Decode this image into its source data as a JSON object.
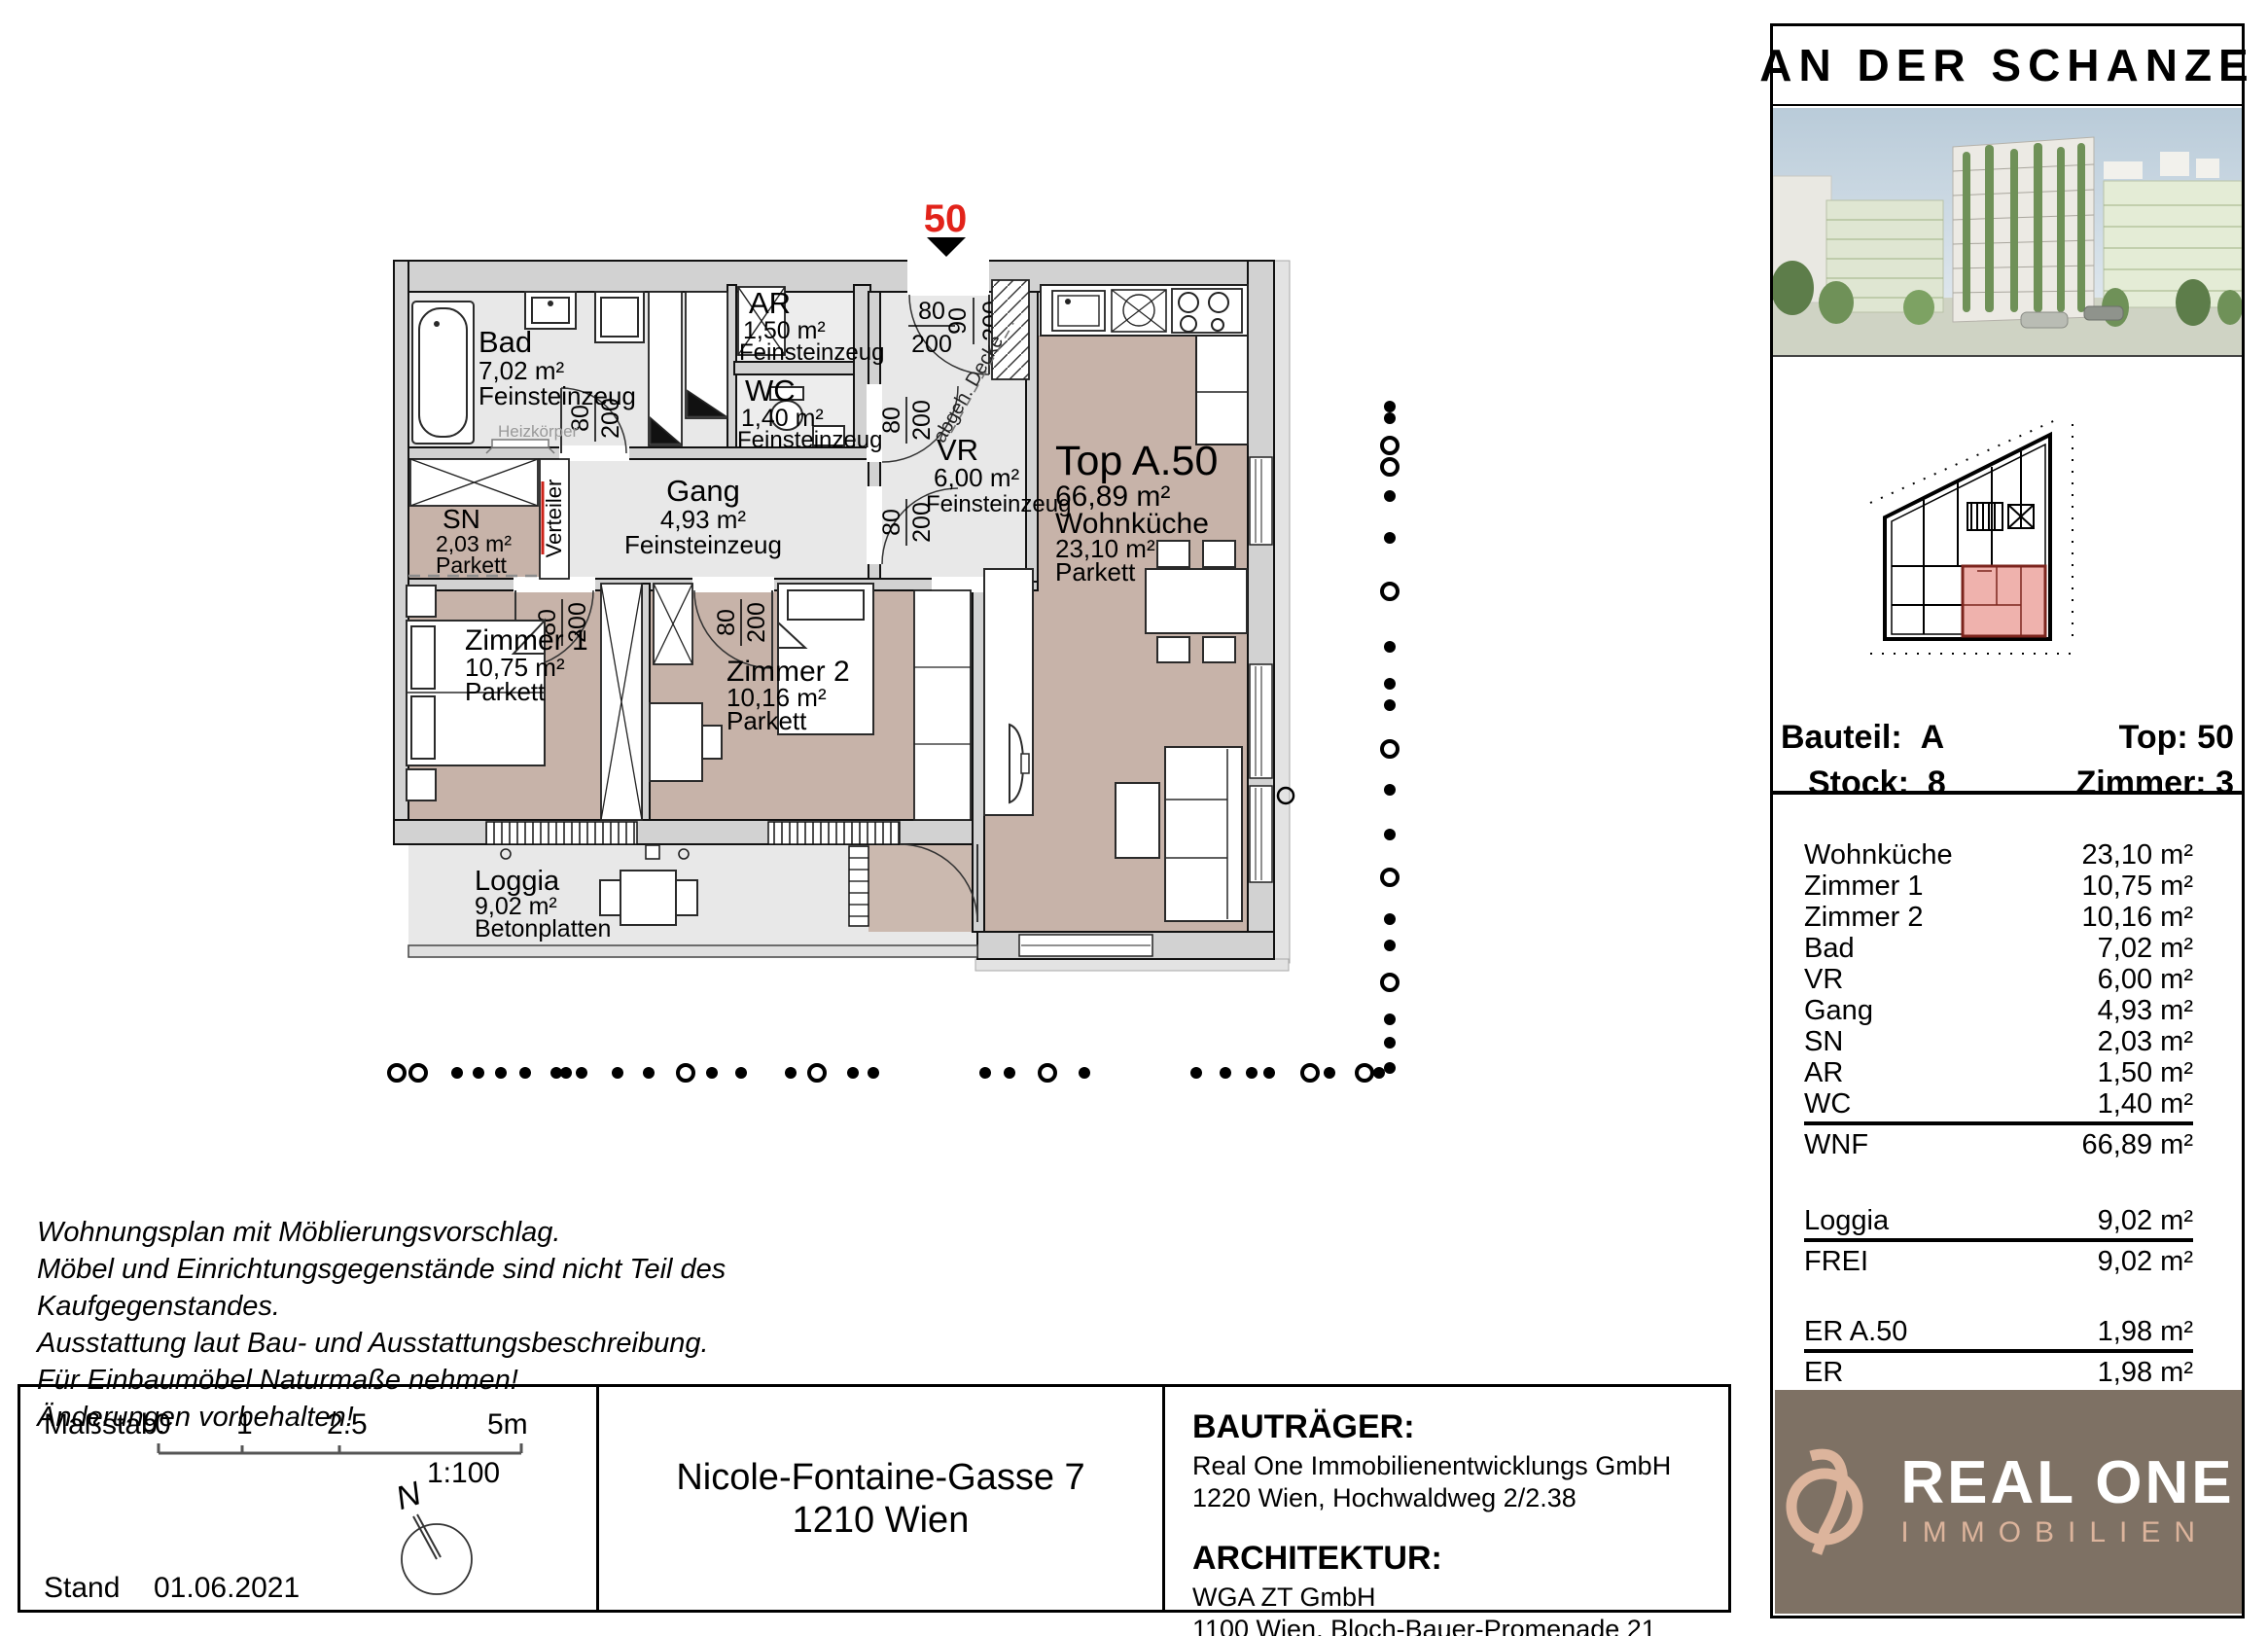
{
  "title": "AN DER SCHANZE",
  "entrance_marker": {
    "number": "50"
  },
  "plan": {
    "rooms": {
      "bad": {
        "name": "Bad",
        "area": "7,02 m²",
        "floor": "Feinsteinzeug"
      },
      "ar": {
        "name": "AR",
        "area": "1,50 m²",
        "floor": "Feinsteinzeug"
      },
      "wc": {
        "name": "WC",
        "area": "1,40 m²",
        "floor": "Feinsteinzeug"
      },
      "vr": {
        "name": "VR",
        "area": "6,00 m²",
        "floor": "Feinsteinzeug"
      },
      "gang": {
        "name": "Gang",
        "area": "4,93 m²",
        "floor": "Feinsteinzeug"
      },
      "sn": {
        "name": "SN",
        "area": "2,03 m²",
        "floor": "Parkett"
      },
      "top": {
        "name": "Top A.50",
        "area": "66,89 m²",
        "room": "Wohnküche",
        "room_area": "23,10 m²",
        "floor": "Parkett"
      },
      "zimmer1": {
        "name": "Zimmer 1",
        "area": "10,75 m²",
        "floor": "Parkett"
      },
      "zimmer2": {
        "name": "Zimmer 2",
        "area": "10,16 m²",
        "floor": "Parkett"
      },
      "loggia": {
        "name": "Loggia",
        "area": "9,02 m²",
        "floor": "Betonplatten"
      }
    },
    "annotations": {
      "heizkoerper": "Heizkörper",
      "verteiler": "Verteiler",
      "abgeh_decke": "abgeh. Decke"
    },
    "door_labels": {
      "w80": "80",
      "w90": "90",
      "h200": "200"
    }
  },
  "unit_info": {
    "bauteil_label": "Bauteil:",
    "bauteil": "A",
    "stock_label": "Stock:",
    "stock": "8",
    "top_label": "Top:",
    "top": "50",
    "zimmer_label": "Zimmer:",
    "zimmer": "3"
  },
  "area_table": {
    "rows": [
      {
        "label": "Wohnküche",
        "value": "23,10 m²"
      },
      {
        "label": "Zimmer 1",
        "value": "10,75 m²"
      },
      {
        "label": "Zimmer 2",
        "value": "10,16 m²"
      },
      {
        "label": "Bad",
        "value": "7,02 m²"
      },
      {
        "label": "VR",
        "value": "6,00 m²"
      },
      {
        "label": "Gang",
        "value": "4,93 m²"
      },
      {
        "label": "SN",
        "value": "2,03 m²"
      },
      {
        "label": "AR",
        "value": "1,50 m²"
      },
      {
        "label": "WC",
        "value": "1,40 m²"
      },
      {
        "label": "WNF",
        "value": "66,89 m²"
      },
      {
        "label": "Loggia",
        "value": "9,02 m²"
      },
      {
        "label": "FREI",
        "value": "9,02 m²"
      },
      {
        "label": "ER A.50",
        "value": "1,98 m²"
      },
      {
        "label": "ER",
        "value": "1,98 m²"
      }
    ]
  },
  "disclaimer": {
    "lines": [
      "Wohnungsplan mit Möblierungsvorschlag.",
      "Möbel und Einrichtungsgegenstände sind nicht Teil des",
      "Kaufgegenstandes.",
      "Ausstattung laut Bau- und Ausstattungsbeschreibung.",
      "Für Einbaumöbel Naturmaße nehmen!",
      "Änderungen vorbehalten!"
    ]
  },
  "scale_box": {
    "label": "Maßstab:",
    "ticks": [
      "0",
      "1",
      "2.5",
      "5m"
    ],
    "ratio": "1:100",
    "north": "N",
    "stand_label": "Stand",
    "stand_date": "01.06.2021"
  },
  "address": {
    "line1": "Nicole-Fontaine-Gasse 7",
    "line2": "1210 Wien"
  },
  "developer": {
    "heading": "BAUTRÄGER:",
    "line1": "Real One Immobilienentwicklungs GmbH",
    "line2": "1220 Wien, Hochwaldweg 2/2.38"
  },
  "architect": {
    "heading": "ARCHITEKTUR:",
    "line1": "WGA ZT GmbH",
    "line2": "1100 Wien, Bloch-Bauer-Promenade 21"
  },
  "logo": {
    "name": "REAL ONE",
    "sub": "IMMOBILIEN"
  },
  "colors": {
    "accent_red": "#e2231a",
    "floor_brown": "#c7b3a9",
    "floor_gray": "#e8e8e8",
    "wall_gray": "#d2d2d2",
    "logo_brown": "#7e7164",
    "logo_beige": "#dcb49c",
    "keyplan_unit_fill": "#efb2ad",
    "keyplan_unit_stroke": "#7b241d"
  }
}
